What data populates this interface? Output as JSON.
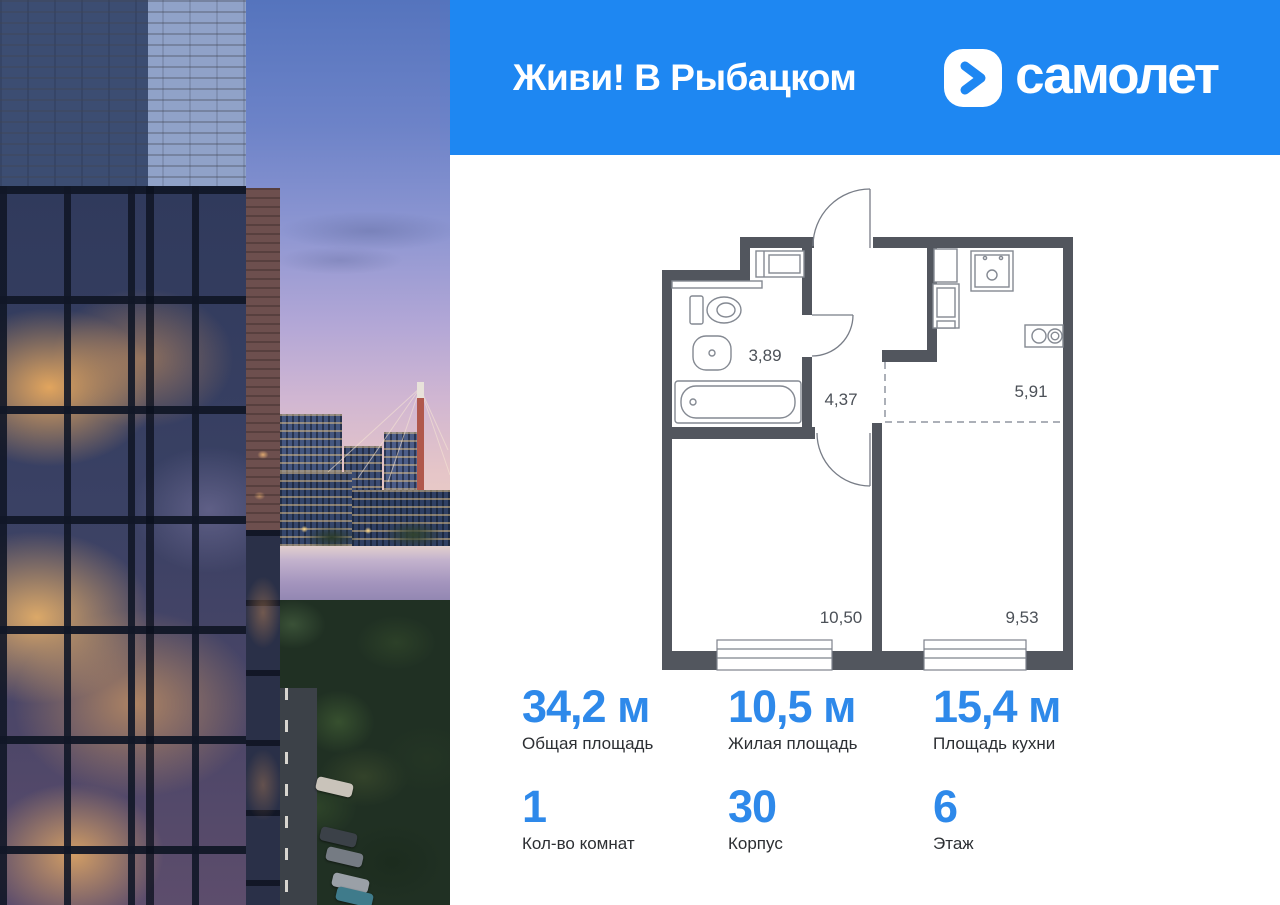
{
  "header": {
    "project_title": "Живи! В Рыбацком",
    "brand_name": "самолет"
  },
  "floor_plan": {
    "areas": {
      "bathroom": "3,89",
      "hallway": "4,37",
      "kitchen": "5,91",
      "living_room": "10,50",
      "bedroom": "9,53"
    }
  },
  "stats": {
    "row1": [
      {
        "value": "34,2 м",
        "label": "Общая площадь"
      },
      {
        "value": "10,5 м",
        "label": "Жилая площадь"
      },
      {
        "value": "15,4 м",
        "label": "Площадь кухни"
      }
    ],
    "row2": [
      {
        "value": "1",
        "label": "Кол-во комнат"
      },
      {
        "value": "30",
        "label": "Корпус"
      },
      {
        "value": "6",
        "label": "Этаж"
      }
    ]
  },
  "colors": {
    "header_blue": "#1e87f2",
    "stat_number_blue": "#2e89ea",
    "plan_wall_gray": "#52565e"
  }
}
